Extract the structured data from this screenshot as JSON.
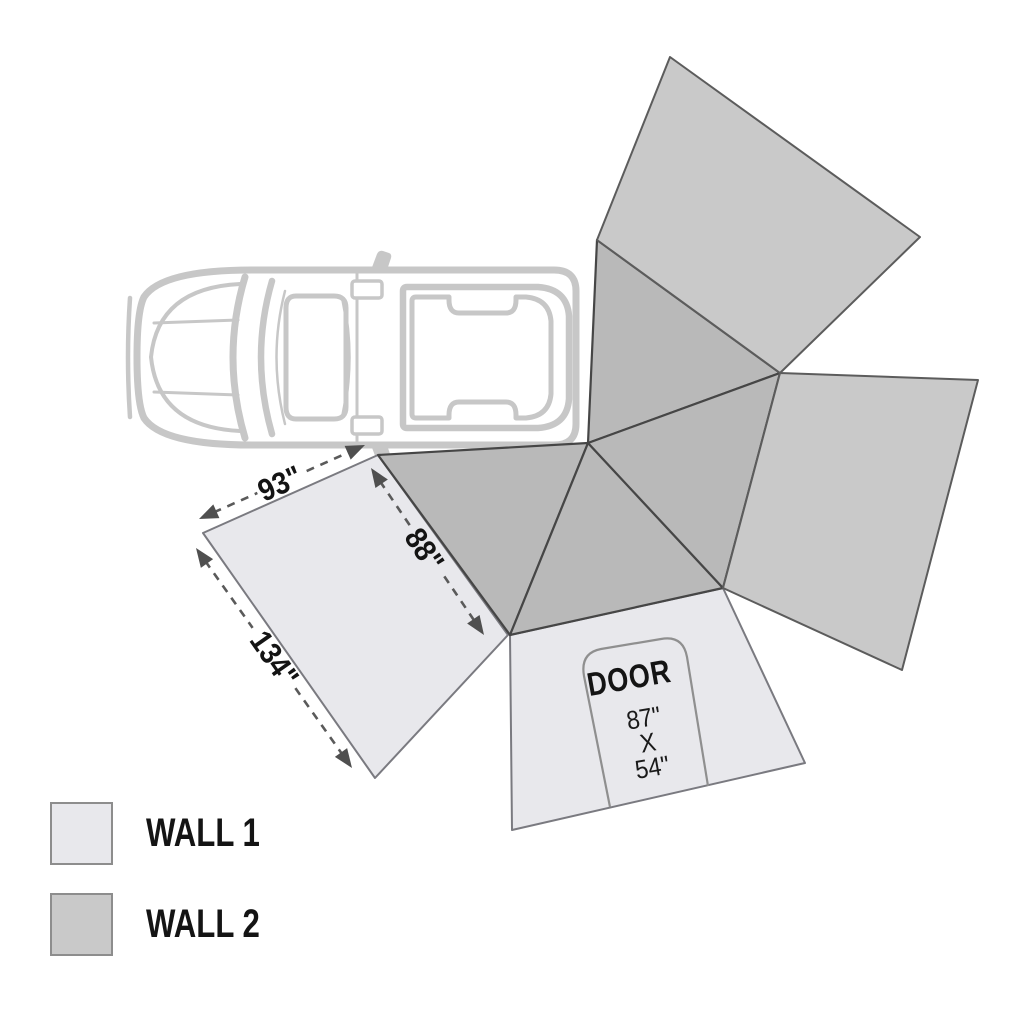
{
  "diagram": {
    "title": "270-degree awning wall layout with vehicle top view",
    "colors": {
      "wall1_fill": "#e8e8ec",
      "wall1_stroke": "#7a7a80",
      "wall2_fill": "#c9c9c9",
      "wall2_stroke": "#5c5c5c",
      "roof_fill": "#b9b9b9",
      "roof_stroke": "#464646",
      "vehicle_color": "#c7c7c7",
      "dim_color": "#5a5a5a",
      "arrow_color": "#4f4f4f",
      "door_outline_color": "#8f8f8f",
      "text_color": "#141414"
    },
    "panels": [
      {
        "name": "wall1-panel",
        "type": "wall1",
        "points": "203,533 378,455 508,635 375,778"
      },
      {
        "name": "door-panel",
        "type": "wall1",
        "points": "510,635 723,588 805,763 512,830"
      },
      {
        "name": "roof-triangle-left",
        "type": "roof",
        "points": "378,455 588,443 510,635"
      },
      {
        "name": "roof-triangle-upper",
        "type": "roof",
        "points": "597,240 780,373 588,443"
      },
      {
        "name": "roof-triangle-lower",
        "type": "roof",
        "points": "588,443 723,588 510,635"
      },
      {
        "name": "roof-triangle-right",
        "type": "roof",
        "points": "780,373 723,588 588,443"
      },
      {
        "name": "wall2-panel-top",
        "type": "wall2",
        "points": "670,57 920,237 780,373 597,240"
      },
      {
        "name": "wall2-panel-right",
        "type": "wall2",
        "points": "780,373 978,380 902,670 723,588"
      }
    ],
    "dimensions": [
      {
        "name": "edge-93",
        "label": "93\"",
        "x1": 199,
        "y1": 519,
        "x2": 365,
        "y2": 445,
        "gap": 27,
        "lx": 280,
        "ly": 484,
        "angle": -24
      },
      {
        "name": "edge-134",
        "label": "134\"",
        "x1": 196,
        "y1": 548,
        "x2": 352,
        "y2": 768,
        "gap": 37,
        "lx": 274,
        "ly": 659,
        "angle": 55
      },
      {
        "name": "edge-88",
        "label": "88\"",
        "x1": 371,
        "y1": 468,
        "x2": 484,
        "y2": 635,
        "gap": 30,
        "lx": 424,
        "ly": 550,
        "angle": 56
      }
    ],
    "door": {
      "label": "DOOR",
      "size_lines": [
        "87\"",
        "X",
        "54\""
      ]
    },
    "legend": [
      {
        "label": "WALL 1",
        "type": "wall1"
      },
      {
        "label": "WALL 2",
        "type": "wall2"
      }
    ]
  }
}
